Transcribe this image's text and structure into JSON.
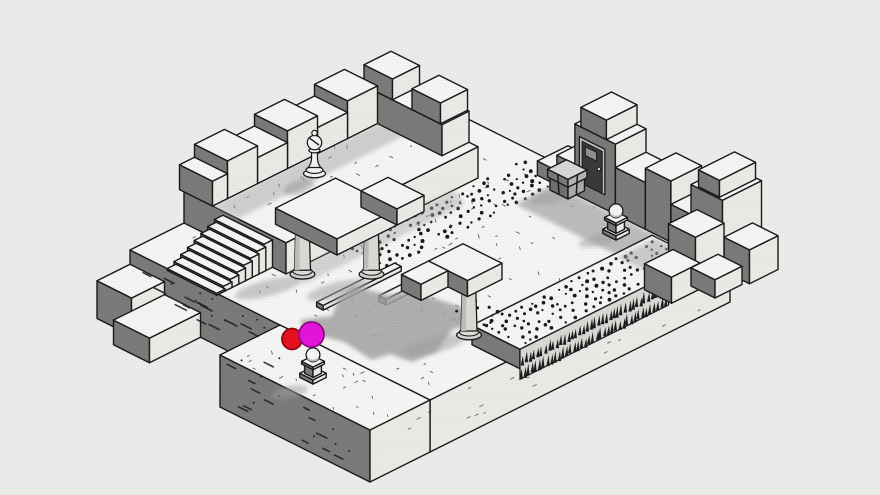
{
  "palette": {
    "bg": "#ebebea",
    "ink": "#1a1a1a",
    "top": "#f4f4f2",
    "se": "#e9e9e6",
    "sw": "#7a7a78",
    "col": "#d8d8d5",
    "dot": "#191919",
    "shadow": "#a9a9a7",
    "red": "#e6101e",
    "magenta": "#e414d8"
  },
  "iso": {
    "ox": 430,
    "oy": 100,
    "ux": 30,
    "uy": 15,
    "uz": 26
  },
  "scene": [
    {
      "t": "box",
      "name": "platform-base",
      "inter": false,
      "x0": 0,
      "x1": 10,
      "y0": 0,
      "y1": 10,
      "z0": -2,
      "z1": 0
    },
    {
      "t": "box",
      "name": "platform-south-wing",
      "inter": false,
      "x0": 5,
      "x1": 10,
      "y0": 10,
      "y1": 12,
      "z0": -2,
      "z1": 0
    },
    {
      "t": "box",
      "name": "west-step-block",
      "inter": false,
      "x0": 0,
      "x1": 1.15,
      "y0": 10,
      "y1": 11.1,
      "z0": -2,
      "z1": -0.55
    },
    {
      "t": "box",
      "name": "west-step-block",
      "inter": false,
      "x0": 1.15,
      "x1": 2.35,
      "y0": 10,
      "y1": 11.7,
      "z0": -2,
      "z1": -1.05
    },
    {
      "t": "ticks",
      "name": "floor-texture",
      "inter": false,
      "rect": [
        0.4,
        9.6,
        0.7,
        9.6
      ],
      "z": 0,
      "n": 130,
      "seed": 7,
      "l": 2.6
    },
    {
      "t": "ticks",
      "name": "floor-texture",
      "inter": false,
      "rect": [
        5.2,
        9.8,
        10.1,
        11.9
      ],
      "z": 0,
      "n": 26,
      "seed": 12,
      "l": 2.4
    },
    {
      "t": "dashy",
      "name": "wall-hatch-texture",
      "inter": false,
      "x0": 0.2,
      "x1": 4.9,
      "y": 10,
      "z0": -1.85,
      "z1": -0.2,
      "n": 15,
      "l": 9
    },
    {
      "t": "dashy",
      "name": "wall-hatch-texture",
      "inter": false,
      "x0": 5.2,
      "x1": 9.8,
      "y": 12,
      "z0": -1.85,
      "z1": -0.2,
      "n": 12,
      "l": 8
    },
    {
      "t": "dashx",
      "name": "wall-tick-texture",
      "inter": false,
      "x": 10,
      "y0": 0.4,
      "y1": 11.6,
      "z0": -1.85,
      "z1": -0.25,
      "n": 18,
      "l": 2.6
    },
    {
      "t": "box",
      "name": "upper-tier",
      "inter": false,
      "x0": 0,
      "x1": 3.4,
      "y0": 1.8,
      "y1": 8.2,
      "z0": 0,
      "z1": 1.2
    },
    {
      "t": "ticks",
      "name": "tier-texture",
      "inter": false,
      "rect": [
        0.3,
        3.2,
        2.1,
        7.9
      ],
      "z": 1.2,
      "n": 26,
      "seed": 4,
      "l": 2.4
    },
    {
      "t": "shg",
      "name": "parapet-shadow",
      "inter": false,
      "pts": [
        [
          0.95,
          2.3
        ],
        [
          1.8,
          2.5
        ],
        [
          1.8,
          8.2
        ],
        [
          0.95,
          8.2
        ]
      ],
      "z": 1.2,
      "op": 0.5,
      "blur": true
    },
    {
      "t": "box",
      "name": "parapet-wall",
      "inter": false,
      "x0": 0.25,
      "x1": 3.1,
      "y0": 1.8,
      "y1": 2.7,
      "z0": 1.2,
      "z1": 2.4
    },
    {
      "t": "box",
      "name": "crenellation-block",
      "inter": false,
      "x0": 0.5,
      "x1": 1.45,
      "y0": 1.8,
      "y1": 2.7,
      "z0": 2.4,
      "z1": 3.2
    },
    {
      "t": "box",
      "name": "crenellation-block",
      "inter": false,
      "x0": 2.1,
      "x1": 3.05,
      "y0": 1.8,
      "y1": 2.7,
      "z0": 2.4,
      "z1": 3.2
    },
    {
      "t": "box",
      "name": "crenellation-block",
      "inter": false,
      "x0": -0.15,
      "x1": 0.95,
      "y0": 2.7,
      "y1": 3.7,
      "z0": 1.2,
      "z1": 2.65
    },
    {
      "t": "box",
      "name": "crenellation-block",
      "inter": false,
      "x0": -0.15,
      "x1": 0.95,
      "y0": 3.7,
      "y1": 4.7,
      "z0": 1.2,
      "z1": 2.2
    },
    {
      "t": "box",
      "name": "crenellation-block",
      "inter": false,
      "x0": -0.15,
      "x1": 0.95,
      "y0": 4.7,
      "y1": 5.7,
      "z0": 1.2,
      "z1": 2.65
    },
    {
      "t": "box",
      "name": "crenellation-block",
      "inter": false,
      "x0": -0.15,
      "x1": 0.95,
      "y0": 5.7,
      "y1": 6.7,
      "z0": 1.2,
      "z1": 2.2
    },
    {
      "t": "box",
      "name": "crenellation-block",
      "inter": false,
      "x0": -0.15,
      "x1": 0.95,
      "y0": 6.7,
      "y1": 7.7,
      "z0": 1.2,
      "z1": 2.65
    },
    {
      "t": "box",
      "name": "crenellation-block",
      "inter": false,
      "x0": -0.15,
      "x1": 0.95,
      "y0": 7.7,
      "y1": 8.2,
      "z0": 1.2,
      "z1": 2.15
    },
    {
      "t": "blob",
      "name": "piece-shadow",
      "inter": false,
      "cx": 299,
      "cy": 187,
      "rx": 16,
      "ry": 6.5,
      "rot": -18,
      "op": 0.6,
      "fill": "#9d9d9b",
      "blur": true
    },
    {
      "t": "bishop",
      "name": "chess-bishop-piece",
      "inter": true,
      "x": 1.6,
      "y": 5.45,
      "z": 1.2
    },
    {
      "t": "stairs",
      "name": "stone-stairs",
      "inter": false,
      "x0": 1.3,
      "x1": 2.95,
      "y": 8.2,
      "n": 8,
      "dy": 0.225,
      "ztop": 1.05,
      "dz": 0.14
    },
    {
      "t": "dots",
      "name": "dotted-path",
      "inter": false,
      "rect": [
        3.55,
        4.9,
        0.4,
        6.4
      ],
      "z": 0,
      "p": 0.24,
      "seed": 5
    },
    {
      "t": "shg",
      "name": "wall-shadow",
      "inter": false,
      "pts": [
        [
          4.9,
          0.75
        ],
        [
          10.35,
          0.75
        ],
        [
          10.35,
          2.05
        ],
        [
          4.9,
          2.05
        ]
      ],
      "z": 0,
      "op": 0.75,
      "blur": true
    },
    {
      "t": "shg",
      "name": "wall-shadow",
      "inter": false,
      "pts": [
        [
          9.15,
          2.05
        ],
        [
          10.35,
          2.05
        ],
        [
          10.35,
          3.1
        ],
        [
          9.15,
          3.1
        ]
      ],
      "z": 0,
      "op": 0.6,
      "blur": true
    },
    {
      "t": "box",
      "name": "raised-walkway",
      "inter": false,
      "x0": 8.6,
      "x1": 10.2,
      "y0": 1.2,
      "y1": 7.2,
      "z0": -0.3,
      "z1": 0.45
    },
    {
      "t": "spikes",
      "name": "spike-trap",
      "inter": false,
      "x": 10.2,
      "y0": 2.25,
      "y1": 7.2,
      "ztop": 0.45,
      "h": 30
    },
    {
      "t": "dots",
      "name": "dotted-path",
      "inter": false,
      "rect": [
        8.75,
        10.05,
        1.35,
        7.05
      ],
      "z": 0.45,
      "p": 0.24,
      "seed": 9
    },
    {
      "t": "shg",
      "name": "wall-shadow",
      "inter": false,
      "pts": [
        [
          8.75,
          1.25
        ],
        [
          10.2,
          1.25
        ],
        [
          10.2,
          2.5
        ],
        [
          8.75,
          2.5
        ]
      ],
      "z": 0.45,
      "op": 0.55,
      "blur": true
    },
    {
      "t": "box",
      "name": "castle-wall-block",
      "inter": false,
      "x0": 4.3,
      "x1": 4.95,
      "y0": -0.3,
      "y1": 0.72,
      "z0": 0,
      "z1": 0.55
    },
    {
      "t": "box",
      "name": "castle-wall-block",
      "inter": false,
      "x0": 4.95,
      "x1": 5.55,
      "y0": -0.3,
      "y1": 0.72,
      "z0": 0,
      "z1": 1.15
    },
    {
      "t": "box",
      "name": "castle-wall-block",
      "inter": false,
      "x0": 5.55,
      "x1": 6.9,
      "y0": -0.3,
      "y1": 0.72,
      "z0": 0,
      "z1": 2.7
    },
    {
      "t": "box",
      "name": "crenellation-block",
      "inter": false,
      "x0": 5.75,
      "x1": 6.6,
      "y0": -0.3,
      "y1": 0.72,
      "z0": 2.7,
      "z1": 3.45
    },
    {
      "t": "door",
      "name": "dungeon-door",
      "inter": true,
      "x0": 5.7,
      "x1": 6.55,
      "y": 0.72,
      "z0": 0.55,
      "z1": 2.3
    },
    {
      "t": "box",
      "name": "castle-wall-block",
      "inter": false,
      "x0": 6.9,
      "x1": 7.9,
      "y0": -0.3,
      "y1": 0.72,
      "z0": 0,
      "z1": 1.8
    },
    {
      "t": "box",
      "name": "castle-wall-block",
      "inter": false,
      "x0": 7.9,
      "x1": 8.75,
      "y0": -0.3,
      "y1": 0.72,
      "z0": 0,
      "z1": 2.35
    },
    {
      "t": "box",
      "name": "castle-wall-block",
      "inter": false,
      "x0": 8.75,
      "x1": 9.55,
      "y0": -0.3,
      "y1": 0.72,
      "z0": 0,
      "z1": 1.45
    },
    {
      "t": "box",
      "name": "corner-tower-block",
      "inter": false,
      "x0": 9.55,
      "x1": 10.6,
      "y0": -0.45,
      "y1": 0.85,
      "z0": 0,
      "z1": 2.75
    },
    {
      "t": "box",
      "name": "crenellation-block",
      "inter": false,
      "x0": 9.75,
      "x1": 10.45,
      "y0": -0.4,
      "y1": 0.8,
      "z0": 2.75,
      "z1": 3.4
    },
    {
      "t": "box",
      "name": "castle-wall-block",
      "inter": false,
      "x0": 10.6,
      "x1": 11.45,
      "y0": -0.15,
      "y1": 0.8,
      "z0": 0,
      "z1": 1.3
    },
    {
      "t": "box",
      "name": "castle-wall-block",
      "inter": false,
      "x0": 9.75,
      "x1": 10.65,
      "y0": 0.85,
      "y1": 1.8,
      "z0": 0,
      "z1": 1.9
    },
    {
      "t": "box",
      "name": "castle-wall-block",
      "inter": false,
      "x0": 9.9,
      "x1": 10.8,
      "y0": 1.8,
      "y1": 2.75,
      "z0": 0,
      "z1": 1.0
    },
    {
      "t": "box",
      "name": "castle-wall-block",
      "inter": false,
      "x0": 10.55,
      "x1": 11.35,
      "y0": 0.95,
      "y1": 1.85,
      "z0": 0,
      "z1": 0.7
    },
    {
      "t": "blob",
      "name": "cast-shadow",
      "inter": false,
      "cx": 553,
      "cy": 196,
      "rx": 24,
      "ry": 7,
      "rot": -14,
      "op": 0.5,
      "fill": "#9d9d9b",
      "blur": true
    },
    {
      "t": "chest",
      "name": "treasure-chest",
      "inter": true,
      "x0": 5.0,
      "x1": 5.6,
      "y0": 0.45,
      "y1": 1.0
    },
    {
      "t": "blob",
      "name": "cast-shadow",
      "inter": false,
      "cx": 598,
      "cy": 240,
      "rx": 20,
      "ry": 6,
      "rot": -14,
      "op": 0.5,
      "fill": "#9d9d9b",
      "blur": true
    },
    {
      "t": "ped",
      "name": "ball-statue",
      "inter": true,
      "x": 7.55,
      "y": 1.35
    },
    {
      "t": "shg",
      "name": "tier-shadow",
      "inter": false,
      "pts": [
        [
          3.4,
          2.6
        ],
        [
          4.05,
          2.9
        ],
        [
          4.05,
          8.2
        ],
        [
          3.4,
          8.2
        ]
      ],
      "z": 0,
      "op": 0.45,
      "blur": true
    },
    {
      "t": "box",
      "name": "balance-beam",
      "inter": false,
      "x0": 5.9,
      "x1": 6.14,
      "y0": 4.9,
      "y1": 7.6,
      "z0": 0.04,
      "z1": 0.26
    },
    {
      "t": "box",
      "name": "balance-beam",
      "inter": false,
      "x0": 5.02,
      "x1": 5.24,
      "y0": 6.2,
      "y1": 8.8,
      "z0": 0.02,
      "z1": 0.2
    },
    {
      "t": "poly",
      "name": "cast-shadow",
      "inter": false,
      "pts": [
        [
          352,
          286
        ],
        [
          388,
          295
        ],
        [
          412,
          291
        ],
        [
          470,
          310
        ],
        [
          476,
          322
        ],
        [
          452,
          330
        ],
        [
          436,
          352
        ],
        [
          412,
          362
        ],
        [
          390,
          354
        ],
        [
          372,
          360
        ],
        [
          344,
          342
        ],
        [
          306,
          332
        ],
        [
          300,
          320
        ],
        [
          332,
          316
        ],
        [
          338,
          300
        ]
      ],
      "fill": "#a2a2a0",
      "op": 0.85,
      "blur": true
    },
    {
      "t": "blob",
      "name": "cast-shadow",
      "inter": false,
      "cx": 268,
      "cy": 288,
      "rx": 34,
      "ry": 8,
      "rot": -14,
      "op": 0.5,
      "fill": "#9d9d9b",
      "blur": true
    },
    {
      "t": "blob",
      "name": "cast-shadow",
      "inter": false,
      "cx": 338,
      "cy": 290,
      "rx": 32,
      "ry": 8,
      "rot": -14,
      "op": 0.5,
      "fill": "#9d9d9b",
      "blur": true
    },
    {
      "t": "col",
      "name": "stone-column",
      "inter": false,
      "x": 3.75,
      "y": 8.0,
      "z0": 0,
      "z1": 2.0,
      "r": 8
    },
    {
      "t": "col",
      "name": "stone-column",
      "inter": false,
      "x": 4.9,
      "y": 6.85,
      "z0": 0,
      "z1": 2.0,
      "r": 8
    },
    {
      "t": "box",
      "name": "gate-lintel",
      "inter": false,
      "x0": 3.3,
      "x1": 5.35,
      "y0": 6.45,
      "y1": 8.45,
      "z0": 2.0,
      "z1": 2.62
    },
    {
      "t": "box",
      "name": "gate-lintel",
      "inter": false,
      "x0": 4.15,
      "x1": 5.35,
      "y0": 5.55,
      "y1": 6.45,
      "z0": 2.0,
      "z1": 2.62
    },
    {
      "t": "dots",
      "name": "dotted-patch",
      "inter": false,
      "rect": [
        7.45,
        8.55,
        5.9,
        6.85
      ],
      "z": 0.02,
      "p": 0.22,
      "seed": 13
    },
    {
      "t": "blob",
      "name": "cast-shadow",
      "inter": false,
      "cx": 434,
      "cy": 345,
      "rx": 32,
      "ry": 8,
      "rot": -14,
      "op": 0.5,
      "fill": "#9d9d9b",
      "blur": true
    },
    {
      "t": "col",
      "name": "stone-column",
      "inter": false,
      "x": 8.55,
      "y": 7.25,
      "z0": 0,
      "z1": 2.1,
      "r": 8
    },
    {
      "t": "box",
      "name": "gate-lintel",
      "inter": false,
      "x0": 7.7,
      "x1": 9.0,
      "y0": 6.6,
      "y1": 7.75,
      "z0": 2.1,
      "z1": 2.72
    },
    {
      "t": "box",
      "name": "gate-lintel",
      "inter": false,
      "x0": 7.7,
      "x1": 8.35,
      "y0": 7.75,
      "y1": 8.65,
      "z0": 2.1,
      "z1": 2.72
    },
    {
      "t": "blob",
      "name": "cast-shadow",
      "inter": false,
      "cx": 290,
      "cy": 392,
      "rx": 18,
      "ry": 6,
      "rot": -12,
      "op": 0.5,
      "fill": "#9d9d9b",
      "blur": true
    },
    {
      "t": "ped",
      "name": "ball-statue",
      "inter": true,
      "x": 7.3,
      "y": 11.2
    },
    {
      "t": "marker",
      "name": "red-ellipse-marker",
      "inter": true,
      "cx": 292,
      "cy": 339,
      "rx": 10,
      "ry": 10.5,
      "fill": "#e6101e",
      "stroke": "#8f0716"
    },
    {
      "t": "marker",
      "name": "magenta-ellipse-marker",
      "inter": true,
      "cx": 311.5,
      "cy": 334.5,
      "rx": 12.5,
      "ry": 12.5,
      "fill": "#e414d8",
      "stroke": "#8d0a85"
    }
  ]
}
